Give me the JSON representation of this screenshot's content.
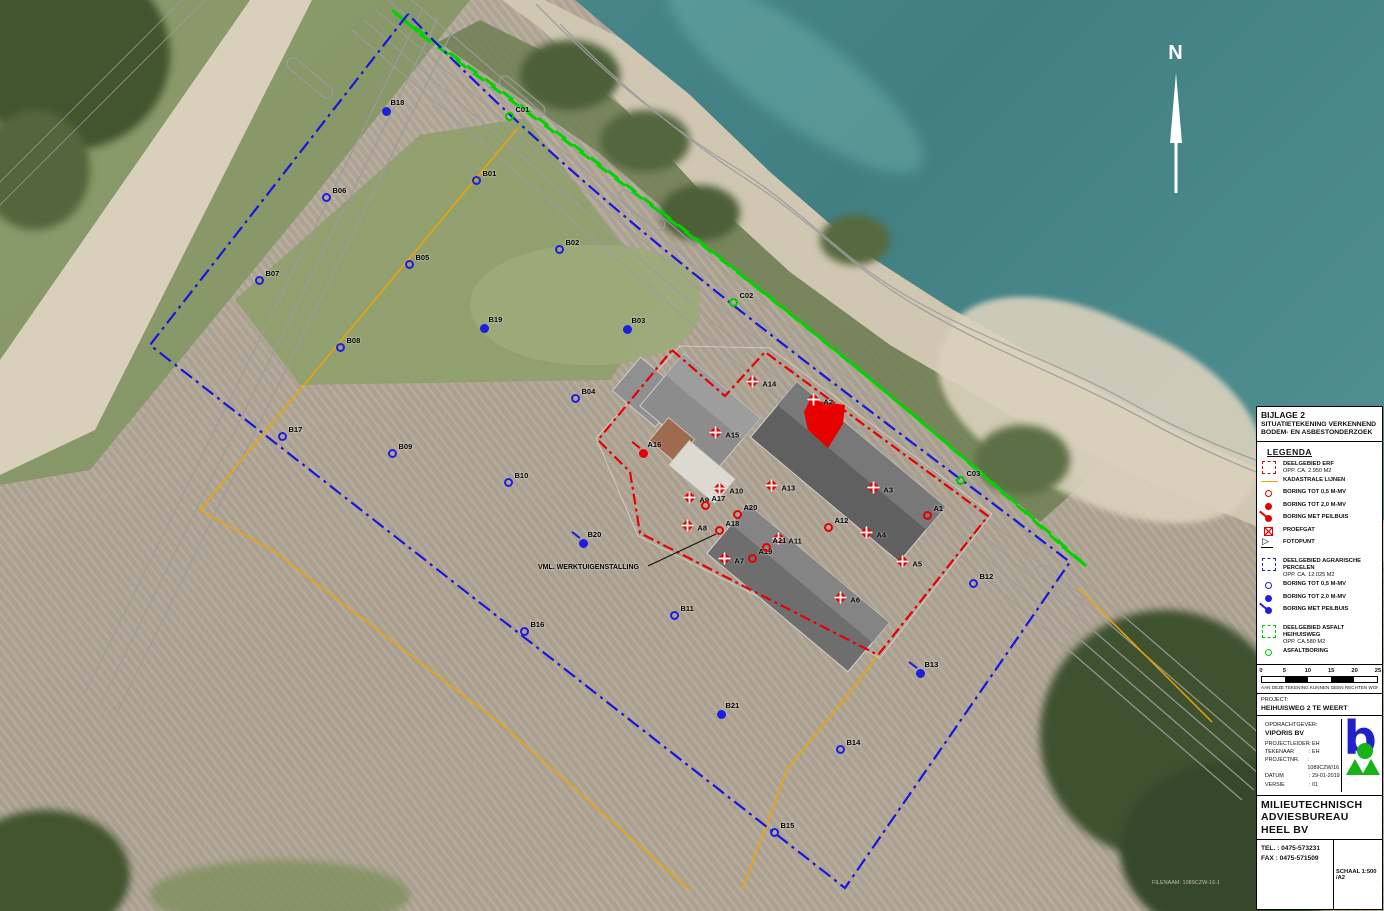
{
  "colors": {
    "erf_red": "#e60000",
    "agrarisch_blue": "#1616dd",
    "asfalt_green": "#00d400",
    "kadastraal_orange": "#f0a400",
    "road_gray": "#9c9c9c",
    "water_teal": "#47868a"
  },
  "map": {
    "north_label": "N",
    "annotation": "VML. WERKTUIGENSTALLING",
    "stamp": "FILENAAM: 1089CZW-16-1",
    "markers": [
      {
        "id": "B01",
        "x": 476,
        "y": 180,
        "type": "open",
        "color": "blue"
      },
      {
        "id": "B02",
        "x": 559,
        "y": 249,
        "type": "open",
        "color": "blue"
      },
      {
        "id": "B03",
        "x": 627,
        "y": 329,
        "type": "filled",
        "color": "blue"
      },
      {
        "id": "B04",
        "x": 575,
        "y": 398,
        "type": "open",
        "color": "blue"
      },
      {
        "id": "B05",
        "x": 409,
        "y": 264,
        "type": "open",
        "color": "blue"
      },
      {
        "id": "B06",
        "x": 326,
        "y": 197,
        "type": "open",
        "color": "blue"
      },
      {
        "id": "B07",
        "x": 259,
        "y": 280,
        "type": "open",
        "color": "blue"
      },
      {
        "id": "B08",
        "x": 340,
        "y": 347,
        "type": "open",
        "color": "blue"
      },
      {
        "id": "B09",
        "x": 392,
        "y": 453,
        "type": "open",
        "color": "blue"
      },
      {
        "id": "B10",
        "x": 508,
        "y": 482,
        "type": "open",
        "color": "blue"
      },
      {
        "id": "B11",
        "x": 674,
        "y": 615,
        "type": "open",
        "color": "blue"
      },
      {
        "id": "B12",
        "x": 973,
        "y": 583,
        "type": "open",
        "color": "blue"
      },
      {
        "id": "B13",
        "x": 920,
        "y": 673,
        "type": "peilbuis",
        "color": "blue"
      },
      {
        "id": "B14",
        "x": 840,
        "y": 749,
        "type": "open",
        "color": "blue"
      },
      {
        "id": "B15",
        "x": 774,
        "y": 832,
        "type": "open",
        "color": "blue"
      },
      {
        "id": "B16",
        "x": 524,
        "y": 631,
        "type": "open",
        "color": "blue"
      },
      {
        "id": "B17",
        "x": 282,
        "y": 436,
        "type": "open",
        "color": "blue"
      },
      {
        "id": "B18",
        "x": 386,
        "y": 111,
        "type": "filled",
        "color": "blue"
      },
      {
        "id": "B19",
        "x": 484,
        "y": 328,
        "type": "filled",
        "color": "blue"
      },
      {
        "id": "B20",
        "x": 583,
        "y": 543,
        "type": "peilbuis",
        "color": "blue"
      },
      {
        "id": "B21",
        "x": 721,
        "y": 714,
        "type": "filled",
        "color": "blue"
      },
      {
        "id": "A1",
        "x": 927,
        "y": 515,
        "type": "open",
        "color": "red"
      },
      {
        "id": "A2",
        "x": 813,
        "y": 399,
        "type": "proefgat",
        "color": "red"
      },
      {
        "id": "A3",
        "x": 873,
        "y": 487,
        "type": "proefgat",
        "color": "red"
      },
      {
        "id": "A4",
        "x": 866,
        "y": 532,
        "type": "proefgat",
        "color": "red"
      },
      {
        "id": "A5",
        "x": 902,
        "y": 561,
        "type": "proefgat",
        "color": "red"
      },
      {
        "id": "A6",
        "x": 840,
        "y": 597,
        "type": "proefgat",
        "color": "red"
      },
      {
        "id": "A7",
        "x": 724,
        "y": 558,
        "type": "proefgat",
        "color": "red"
      },
      {
        "id": "A8",
        "x": 687,
        "y": 525,
        "type": "proefgat",
        "color": "red"
      },
      {
        "id": "A9",
        "x": 689,
        "y": 497,
        "type": "proefgat",
        "color": "red"
      },
      {
        "id": "A10",
        "x": 719,
        "y": 488,
        "type": "proefgat",
        "color": "red"
      },
      {
        "id": "A11",
        "x": 778,
        "y": 538,
        "type": "proefgat",
        "color": "red"
      },
      {
        "id": "A12",
        "x": 828,
        "y": 527,
        "type": "open",
        "color": "red"
      },
      {
        "id": "A13",
        "x": 771,
        "y": 485,
        "type": "proefgat",
        "color": "red"
      },
      {
        "id": "A14",
        "x": 752,
        "y": 381,
        "type": "proefgat",
        "color": "red"
      },
      {
        "id": "A15",
        "x": 715,
        "y": 432,
        "type": "proefgat",
        "color": "red"
      },
      {
        "id": "A16",
        "x": 643,
        "y": 453,
        "type": "peilbuis",
        "color": "red"
      },
      {
        "id": "A17",
        "x": 705,
        "y": 505,
        "type": "open",
        "color": "red"
      },
      {
        "id": "A18",
        "x": 719,
        "y": 530,
        "type": "open",
        "color": "red"
      },
      {
        "id": "A19",
        "x": 752,
        "y": 558,
        "type": "open",
        "color": "red"
      },
      {
        "id": "A20",
        "x": 737,
        "y": 514,
        "type": "open",
        "color": "red"
      },
      {
        "id": "A21",
        "x": 766,
        "y": 547,
        "type": "open",
        "color": "red"
      },
      {
        "id": "C01",
        "x": 509,
        "y": 116,
        "type": "asfalt",
        "color": "green"
      },
      {
        "id": "C02",
        "x": 733,
        "y": 302,
        "type": "asfalt",
        "color": "green"
      },
      {
        "id": "C03",
        "x": 960,
        "y": 480,
        "type": "asfalt",
        "color": "green"
      }
    ]
  },
  "panel": {
    "title_lines": [
      "BIJLAGE 2",
      "SITUATIETEKENING VERKENNEND",
      "BODEM- EN ASBESTONDERZOEK"
    ],
    "legend_title": "LEGENDA",
    "legend": [
      {
        "icon": "area-red",
        "label": "DEELGEBIED ERF",
        "sub": "OPP. CA. 2.950 M2"
      },
      {
        "icon": "line-orange",
        "label": "KADASTRALE LIJNEN"
      },
      {
        "icon": "c-open red",
        "label": "BORING TOT 0,5 M-MV"
      },
      {
        "icon": "c-filled red",
        "label": "BORING TOT 2,0 M-MV"
      },
      {
        "icon": "c-peil red",
        "label": "BORING MET PEILBUIS"
      },
      {
        "icon": "proefgat-red",
        "label": "PROEFGAT"
      },
      {
        "icon": "fotopunt",
        "label": "FOTOPUNT"
      },
      {
        "icon": "area-blue",
        "label": "DEELGEBIED AGRARISCHE PERCELEN",
        "sub": "OPP. CA. 12.025 M2"
      },
      {
        "icon": "c-open blue",
        "label": "BORING TOT 0,5 M-MV"
      },
      {
        "icon": "c-filled blue",
        "label": "BORING TOT 2,0 M-MV"
      },
      {
        "icon": "c-peil blue",
        "label": "BORING MET PEILBUIS"
      },
      {
        "icon": "area-green",
        "label": "DEELGEBIED ASFALT HEIHUISWEG",
        "sub": "OPP. CA.580 M2"
      },
      {
        "icon": "c-open green",
        "label": "ASFALTBORING"
      }
    ],
    "scalebar": {
      "ticks": [
        "0",
        "5",
        "10",
        "15",
        "20",
        "25"
      ],
      "note": "AAN DEZE TEKENING KUNNEN GEEN RECHTEN WORDEN ONTLEEND"
    },
    "project_label": "PROJECT:",
    "project_value": "HEIHUISWEG 2 TE WEERT",
    "client_label": "OPDRACHTGEVER:",
    "client_value": "VIPORIS BV",
    "meta": [
      {
        "k": "PROJECTLEIDER",
        "v": "EH"
      },
      {
        "k": "TEKENAAR",
        "v": "EH"
      },
      {
        "k": "PROJECTNR.",
        "v": "1089CZW/16"
      },
      {
        "k": "DATUM",
        "v": "29-01-2019"
      },
      {
        "k": "VERSIE",
        "v": "01"
      }
    ],
    "company": [
      "MILIEUTECHNISCH",
      "ADVIESBUREAU HEEL BV"
    ],
    "tel": "TEL. : 0475-573231",
    "fax": "FAX : 0475-571509",
    "schaal": "SCHAAL 1:500 /A2"
  }
}
